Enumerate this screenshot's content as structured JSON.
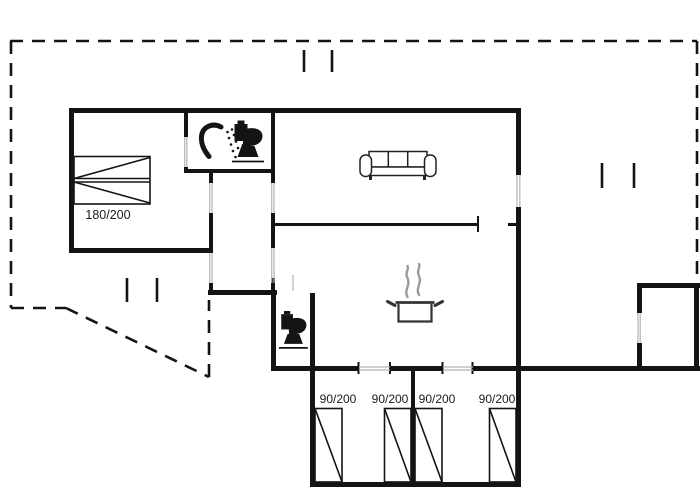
{
  "plan": {
    "colors": {
      "wall": "#141414",
      "door_window_line": "#b5b5b5",
      "steam": "#9a9a9a",
      "background": "#ffffff"
    },
    "double_bed": {
      "label": "180/200"
    },
    "bunk_beds": [
      {
        "label": "90/200"
      },
      {
        "label": "90/200"
      },
      {
        "label": "90/200"
      },
      {
        "label": "90/200"
      }
    ],
    "icons": {
      "bathroom": [
        "shower-icon",
        "toilet-icon"
      ],
      "living_room": [
        "sofa-icon"
      ],
      "kitchen": [
        "cooking-pot-icon",
        "steam-icon"
      ],
      "wc": [
        "toilet-icon"
      ]
    }
  }
}
